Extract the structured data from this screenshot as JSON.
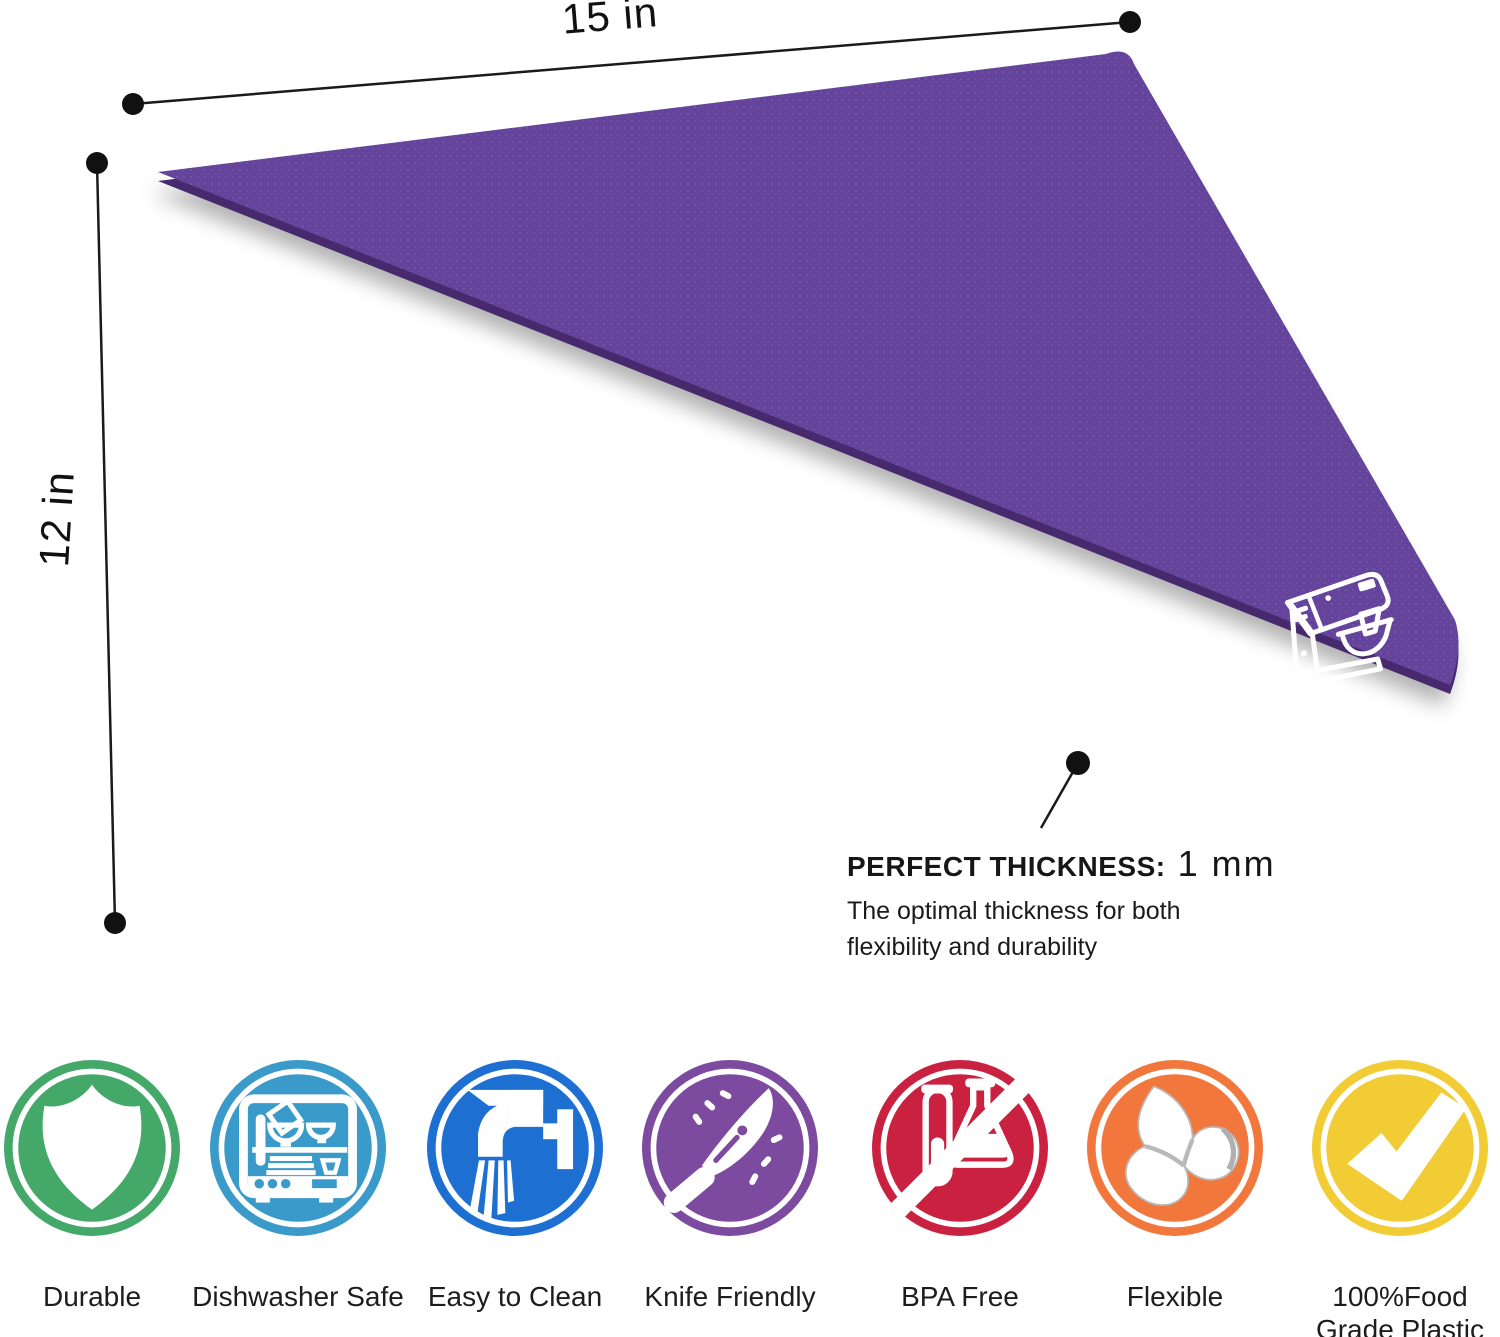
{
  "dimensions": {
    "width_label": "15 in",
    "height_label": "12 in"
  },
  "callout": {
    "title": "PERFECT THICKNESS:",
    "value": "1 mm",
    "desc_line1": "The optimal thickness for both",
    "desc_line2": "flexibility and durability"
  },
  "mat": {
    "base_color": "#64439a",
    "dot_color": "#7a5cae",
    "edge_color": "#46296e",
    "logo_color": "#ffffff"
  },
  "features": [
    {
      "label": "Durable",
      "color": "#44a868",
      "icon": "shield-icon"
    },
    {
      "label": "Dishwasher Safe",
      "color": "#3a9ac9",
      "icon": "dishwasher-icon"
    },
    {
      "label": "Easy to Clean",
      "color": "#1d6fd1",
      "icon": "faucet-icon"
    },
    {
      "label": "Knife Friendly",
      "color": "#7c4ba0",
      "icon": "knife-icon"
    },
    {
      "label": "BPA Free",
      "color": "#cb2140",
      "icon": "no-bpa-icon"
    },
    {
      "label": "Flexible",
      "color": "#f1773c",
      "icon": "flexible-mat-icon"
    },
    {
      "label": "100%Food\nGrade Plastic",
      "color": "#f1cc35",
      "icon": "checkmark-icon"
    }
  ]
}
